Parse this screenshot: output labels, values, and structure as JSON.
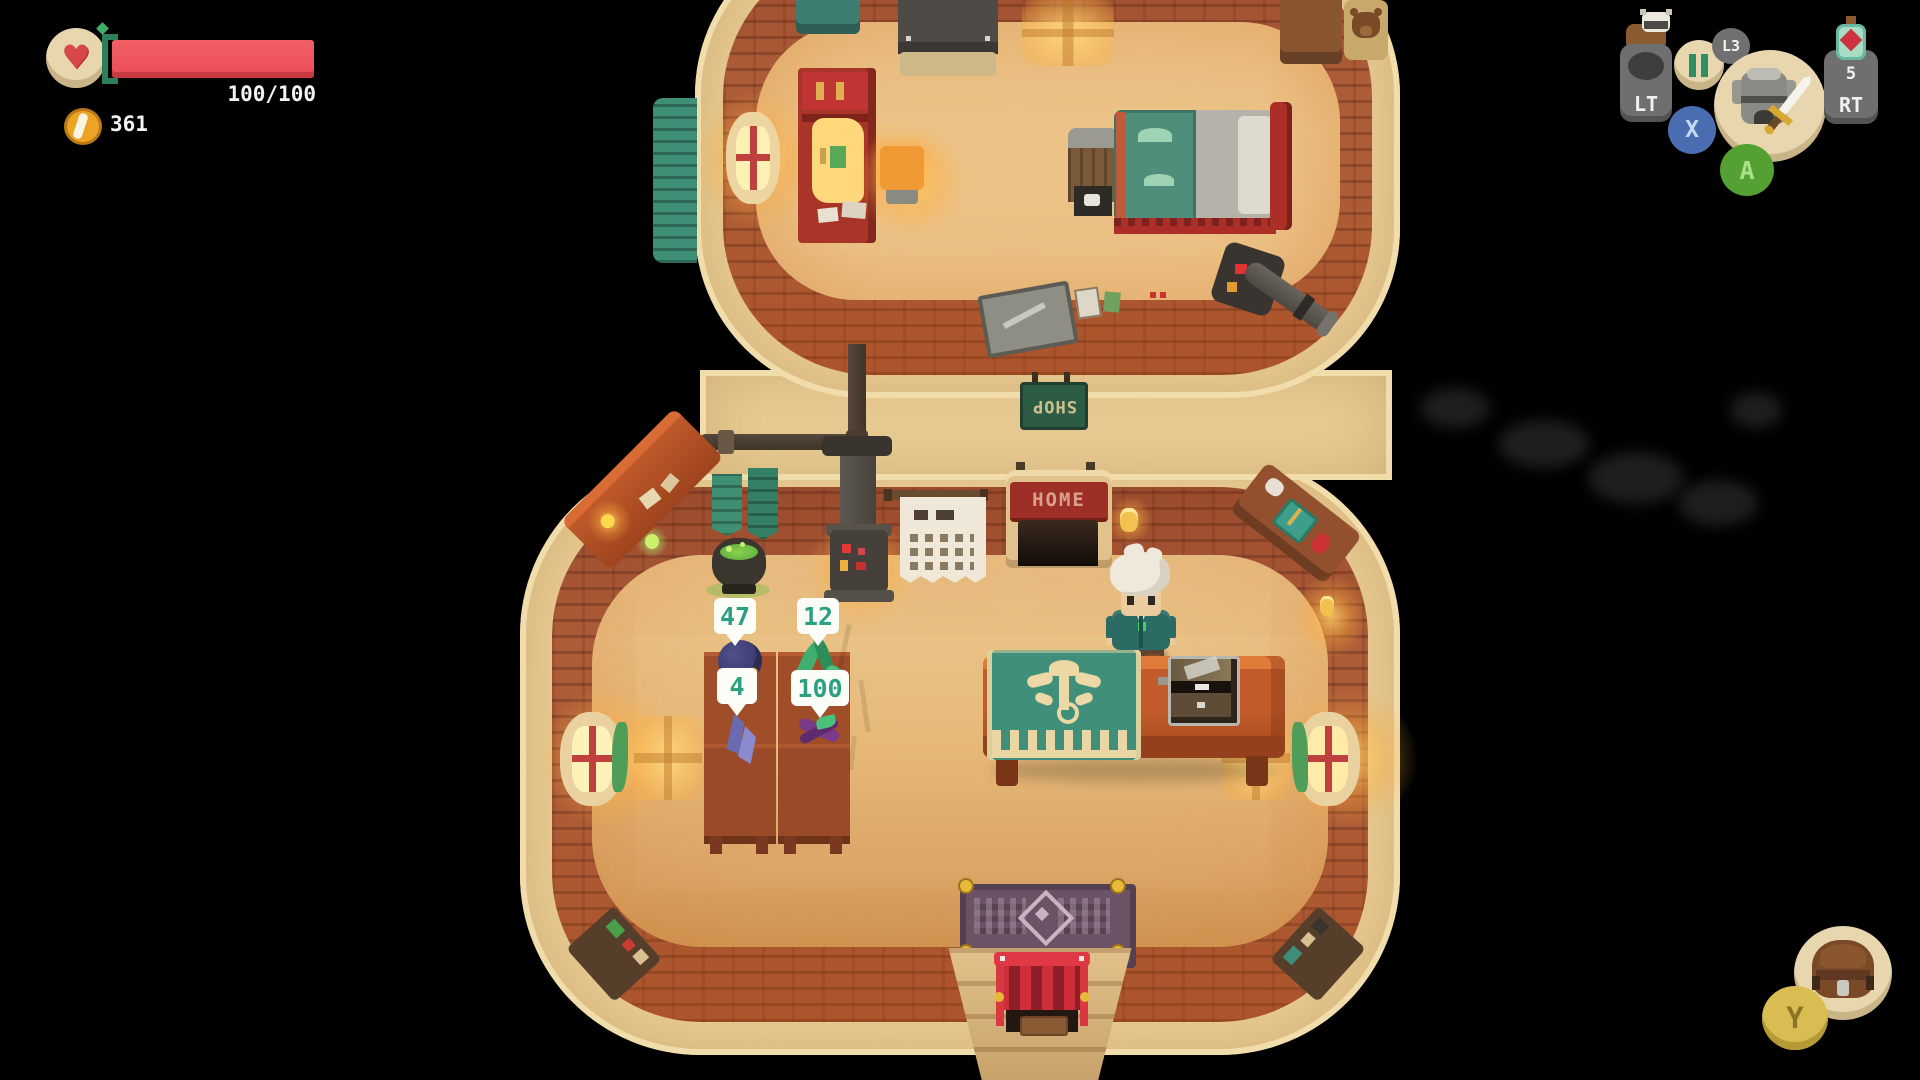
{
  "hud": {
    "health": {
      "value_label": "100/100"
    },
    "gold": {
      "amount": "361"
    },
    "controller": {
      "lt_label": "LT",
      "l3_label": "L3",
      "x_label": "X",
      "a_label": "A",
      "rt_label": "RT",
      "rt_potion_count": "5",
      "y_label": "Y"
    }
  },
  "signs": {
    "shop_sign": "SHOP",
    "home_sign": "HOME"
  },
  "shop": {
    "price_tags": [
      {
        "value": "47"
      },
      {
        "value": "12"
      },
      {
        "value": "4"
      },
      {
        "value": "100"
      }
    ]
  },
  "icons": {
    "heart": "pixel-heart",
    "coin": "gold-coin",
    "pause": "pause-bars",
    "companion": "companion-sprite",
    "equipped": "armor-and-sword",
    "potion": "health-potion",
    "inventory": "backpack"
  },
  "colors": {
    "health_bar": "#ef5258",
    "health_cap": "#2f7e5a",
    "coin": "#eda426",
    "price_text": "#2aa183",
    "button_x": "#4a6cb0",
    "button_a": "#54a032",
    "button_y": "#d9bd52",
    "hud_circle": "#e7d6ae",
    "hud_button_gray": "#6f6f6f",
    "shop_sign_bg": "#2d5c45",
    "home_banner": "#9e2f26"
  }
}
